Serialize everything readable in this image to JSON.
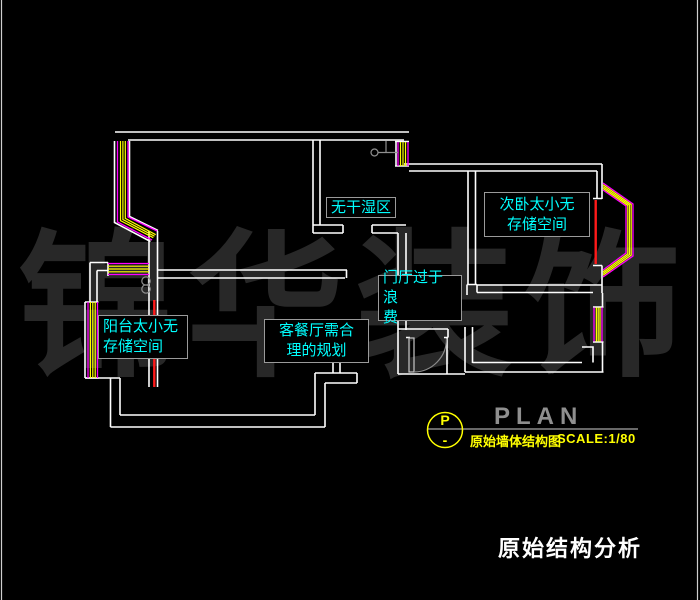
{
  "plan": {
    "annotations": {
      "wet_area": {
        "lines": [
          "无干湿区"
        ]
      },
      "second_bedroom": {
        "lines": [
          "次卧太小无",
          "存储空间"
        ]
      },
      "entry_hall": {
        "lines": [
          "门厅过于浪",
          "费"
        ]
      },
      "balcony": {
        "lines": [
          "阳台太小无",
          "存储空间"
        ]
      },
      "living_dining": {
        "lines": [
          "客餐厅需合",
          "理的规划"
        ]
      }
    }
  },
  "legend": {
    "marker_top": "P",
    "marker_bottom": "-",
    "title": "PLAN",
    "drawing_name": "原始墙体结构图",
    "scale": "SCALE:1/80"
  },
  "footer": {
    "title": "原始结构分析"
  },
  "watermark": {
    "characters": [
      "锦",
      "华",
      "装",
      "饰"
    ]
  },
  "colors": {
    "background": "#000000",
    "wall_line": "#ffffff",
    "window_frame": "#ff00ff",
    "window_glass": "#ffff00",
    "highlight_red": "#ff1a1a",
    "annotation_text": "#00ffff",
    "annotation_border": "#9a9a9a",
    "legend_accent": "#ffff00",
    "legend_muted": "#8f8f8f",
    "watermark": "#282828"
  }
}
